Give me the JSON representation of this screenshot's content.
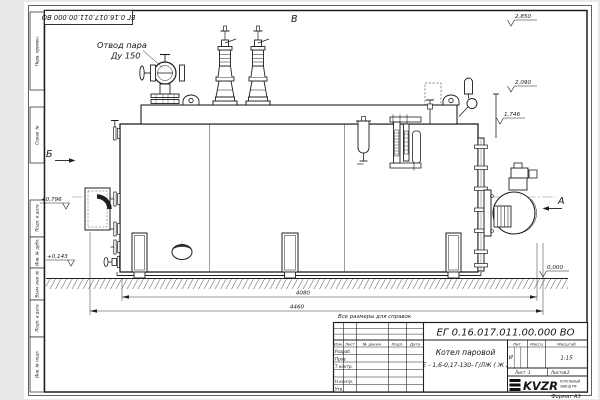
{
  "page": {
    "stamp_top": "ЕГ 0.16.017.011.00.000  ВО",
    "format_note": "Формат А3",
    "reference_note": "Все размеры для справок"
  },
  "margin": {
    "cells": [
      {
        "label": "Перв. примен."
      },
      {
        "label": "Справ. №"
      },
      {
        "label": "Подп. и дата"
      },
      {
        "label": "Инв. № дубл."
      },
      {
        "label": "Взам. инв. №"
      },
      {
        "label": "Подп. и дата"
      },
      {
        "label": "Инв. № подл."
      }
    ]
  },
  "drawing": {
    "labels": {
      "steam_outlet_1": "Отвод пара",
      "steam_outlet_2": "Ду 150",
      "view_top": "В",
      "view_left": "Б",
      "view_right": "А"
    },
    "elevations": {
      "e1": "2,850",
      "e2": "2,090",
      "e3": "1,746",
      "e4": "0,000",
      "e5": "+0,796",
      "e6": "+0,143"
    },
    "dimensions": {
      "inner": "4080",
      "overall": "4460"
    }
  },
  "title_block": {
    "doc_number": "ЕГ 0.16.017.011.00.000   ВО",
    "product_name_1": "Котел паровой",
    "product_name_2": "Е - 1,6-0,17-130- Г/ЛЖ ( Ж )",
    "change_table": {
      "headers": [
        "Изм.",
        "Лист",
        "№ докум.",
        "Подп.",
        "Дата"
      ],
      "rows": [
        "Разраб.",
        "Пров.",
        "Т.контр.",
        "Н.контр.",
        "Утв."
      ]
    },
    "lit_header": "Лит.",
    "mass_header": "Масса",
    "scale_header": "Масштаб",
    "lit_value": "И",
    "scale_value": "1:15",
    "sheet_label": "Лист",
    "sheet_value": "1",
    "sheets_label": "Листов",
    "sheets_value": "2",
    "logo_text": "KVZR",
    "logo_sub_1": "КОТЕЛЬНЫЙ",
    "logo_sub_2": "ЗАВОД РФ"
  }
}
